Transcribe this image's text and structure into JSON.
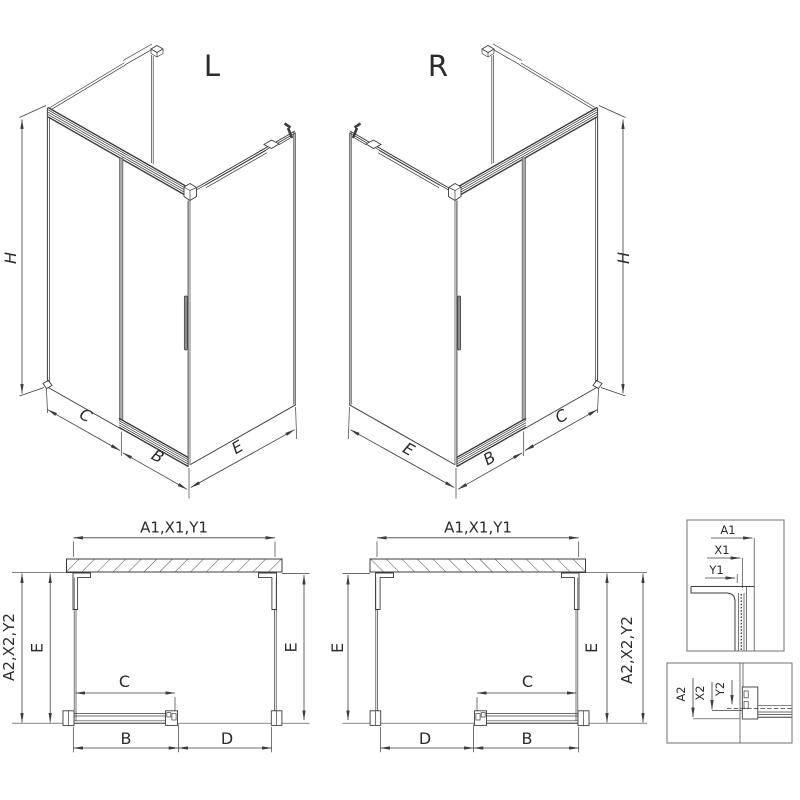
{
  "document": {
    "type": "technical-drawing",
    "subject": "corner shower enclosure with sliding door, left and right variants"
  },
  "colors": {
    "line": "#3c3c3c",
    "detail_border": "#7d7d7d",
    "background": "#ffffff"
  },
  "iso_left": {
    "title": "L",
    "dim_height": "H",
    "dim_fixed": "C",
    "dim_door": "B",
    "dim_side": "E"
  },
  "iso_right": {
    "title": "R",
    "dim_height": "H",
    "dim_fixed": "C",
    "dim_door": "B",
    "dim_side": "E"
  },
  "plan_left": {
    "dim_top": "A1,X1,Y1",
    "dim_outer": "A2,X2,Y2",
    "dim_e_left": "E",
    "dim_e_right": "E",
    "dim_c": "C",
    "dim_b": "B",
    "dim_d": "D"
  },
  "plan_right": {
    "dim_top": "A1,X1,Y1",
    "dim_outer": "A2,X2,Y2",
    "dim_e_left": "E",
    "dim_e_right": "E",
    "dim_c": "C",
    "dim_b": "B",
    "dim_d": "D"
  },
  "detail_top": {
    "dim_a1": "A1",
    "dim_x1": "X1",
    "dim_y1": "Y1"
  },
  "detail_bottom": {
    "dim_a2": "A2",
    "dim_x2": "X2",
    "dim_y2": "Y2"
  }
}
